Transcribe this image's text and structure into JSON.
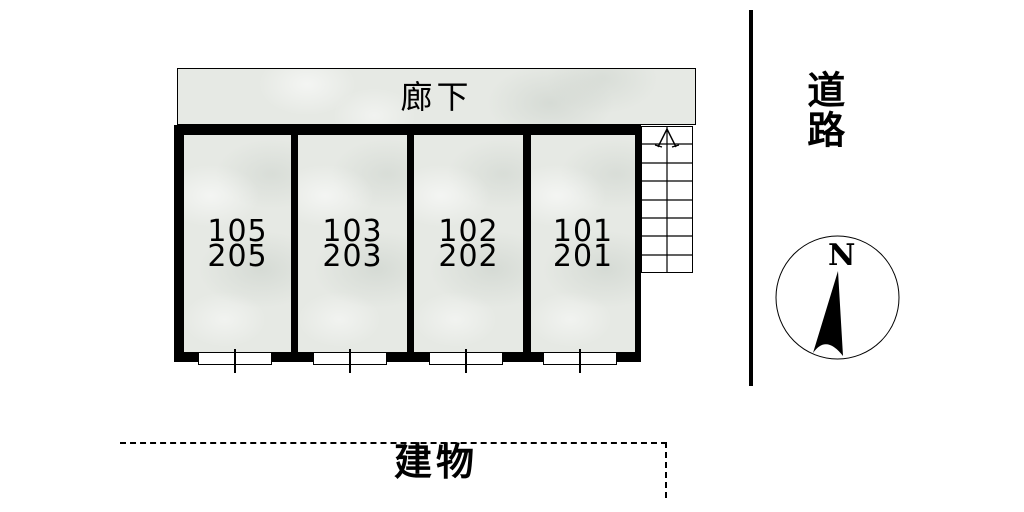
{
  "floorplan": {
    "corridor_label": "廊下",
    "rooms": [
      {
        "upper": "105",
        "lower": "205"
      },
      {
        "upper": "103",
        "lower": "203"
      },
      {
        "upper": "102",
        "lower": "202"
      },
      {
        "upper": "101",
        "lower": "201"
      }
    ],
    "road_label": "道路",
    "building_label": "建物",
    "compass_north_label": "N",
    "icons": {
      "stairs_direction": "stairs-up-arrow",
      "compass_needle": "compass-north-needle"
    }
  },
  "colors": {
    "wall": "#000000",
    "floor_fill": "#e6e9e4",
    "line": "#000000",
    "background": "#ffffff"
  }
}
